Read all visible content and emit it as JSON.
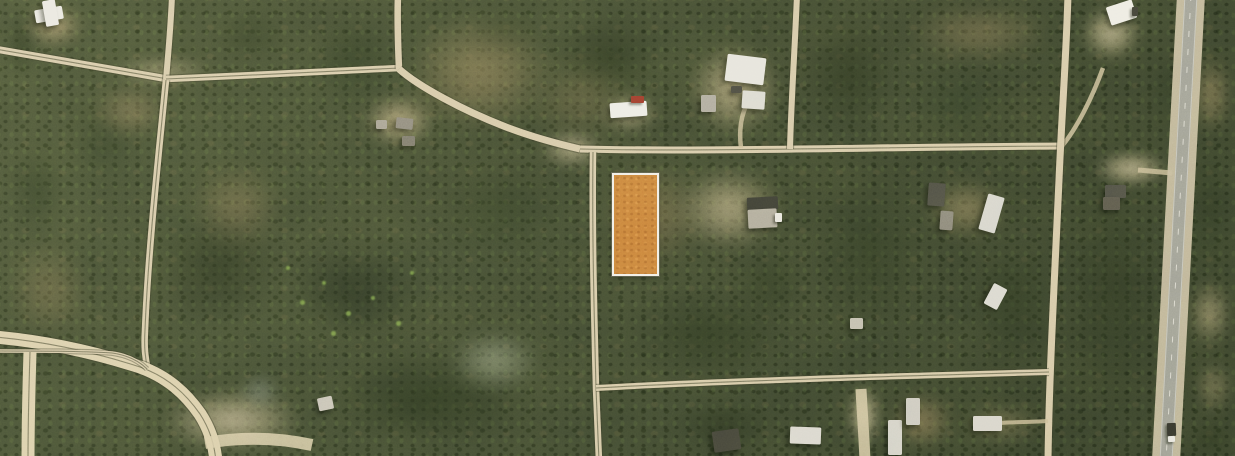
{
  "app": {
    "view_type": "aerial-satellite-parcel-view",
    "visible_text": "none"
  },
  "palette": {
    "forest_base": "#47503a",
    "dirt_road": "#d6c9ab",
    "bright_sand": "#dbcfae",
    "driveway": "#cdbf9d",
    "road_edge": "rgba(58,60,42,0.42)",
    "asphalt": "#a1a199",
    "shoulder": "#c7bda2",
    "parcel_fill": "#c9823e",
    "parcel_border": "#f1eee6"
  },
  "parcel": {
    "x": 612,
    "y": 173,
    "w": 43,
    "h": 99,
    "fill": "#c9823e",
    "border": "#f1eee6",
    "border_w": 2
  },
  "scene": {
    "clearings": [
      {
        "x": 18,
        "y": 0,
        "w": 72,
        "h": 52,
        "color": "#b9a57f",
        "opacity": 0.75,
        "blur": 6
      },
      {
        "x": 85,
        "y": 80,
        "w": 92,
        "h": 62,
        "color": "#9c8a66",
        "opacity": 0.6,
        "blur": 8
      },
      {
        "x": 100,
        "y": 52,
        "w": 125,
        "h": 38,
        "color": "#c6b894",
        "opacity": 0.55,
        "blur": 6
      },
      {
        "x": 355,
        "y": 88,
        "w": 88,
        "h": 66,
        "color": "#c3b28c",
        "opacity": 0.8,
        "blur": 6
      },
      {
        "x": 593,
        "y": 90,
        "w": 72,
        "h": 46,
        "color": "#c9bb96",
        "opacity": 0.7,
        "blur": 6
      },
      {
        "x": 678,
        "y": 33,
        "w": 112,
        "h": 112,
        "color": "#c5b690",
        "opacity": 0.75,
        "blur": 7
      },
      {
        "x": 533,
        "y": 126,
        "w": 78,
        "h": 46,
        "color": "#cec1a0",
        "opacity": 0.7,
        "blur": 6
      },
      {
        "x": 593,
        "y": 150,
        "w": 122,
        "h": 130,
        "color": "#a78f68",
        "opacity": 0.45,
        "blur": 9
      },
      {
        "x": 663,
        "y": 158,
        "w": 132,
        "h": 102,
        "color": "#c8b994",
        "opacity": 0.72,
        "blur": 8
      },
      {
        "x": 918,
        "y": 173,
        "w": 97,
        "h": 72,
        "color": "#a8956e",
        "opacity": 0.6,
        "blur": 8
      },
      {
        "x": 1075,
        "y": 0,
        "w": 72,
        "h": 66,
        "color": "#cdc09c",
        "opacity": 0.8,
        "blur": 6
      },
      {
        "x": 1085,
        "y": 147,
        "w": 92,
        "h": 43,
        "color": "#cfc2a0",
        "opacity": 0.82,
        "blur": 5
      },
      {
        "x": 1188,
        "y": 46,
        "w": 47,
        "h": 96,
        "color": "#a5916a",
        "opacity": 0.6,
        "blur": 7
      },
      {
        "x": 1185,
        "y": 273,
        "w": 50,
        "h": 82,
        "color": "#c2b28c",
        "opacity": 0.65,
        "blur": 7
      },
      {
        "x": 843,
        "y": 376,
        "w": 42,
        "h": 80,
        "color": "#cfc2a2",
        "opacity": 0.8,
        "blur": 5
      },
      {
        "x": 883,
        "y": 386,
        "w": 78,
        "h": 70,
        "color": "#a78f68",
        "opacity": 0.6,
        "blur": 7
      },
      {
        "x": 148,
        "y": 383,
        "w": 168,
        "h": 75,
        "color": "#cdbf9e",
        "opacity": 0.8,
        "blur": 7
      },
      {
        "x": 235,
        "y": 370,
        "w": 50,
        "h": 42,
        "color": "#8e9894",
        "opacity": 0.5,
        "blur": 6
      },
      {
        "x": 438,
        "y": 323,
        "w": 112,
        "h": 76,
        "color": "#b9c0a8",
        "opacity": 0.5,
        "blur": 8
      },
      {
        "x": 893,
        "y": 0,
        "w": 172,
        "h": 66,
        "color": "#9a8762",
        "opacity": 0.5,
        "blur": 9
      },
      {
        "x": 388,
        "y": 0,
        "w": 182,
        "h": 146,
        "color": "#9d8a64",
        "opacity": 0.6,
        "blur": 10
      },
      {
        "x": 518,
        "y": 53,
        "w": 122,
        "h": 92,
        "color": "#8a7a58",
        "opacity": 0.4,
        "blur": 10
      },
      {
        "x": 0,
        "y": 233,
        "w": 96,
        "h": 112,
        "color": "#96845f",
        "opacity": 0.45,
        "blur": 10
      },
      {
        "x": 183,
        "y": 158,
        "w": 107,
        "h": 97,
        "color": "#9a8762",
        "opacity": 0.5,
        "blur": 10
      },
      {
        "x": 953,
        "y": 403,
        "w": 97,
        "h": 42,
        "color": "#ab9870",
        "opacity": 0.5,
        "blur": 8
      },
      {
        "x": 1192,
        "y": 356,
        "w": 43,
        "h": 62,
        "color": "#b5a47e",
        "opacity": 0.5,
        "blur": 7
      }
    ],
    "wetland": {
      "x": 272,
      "y": 233,
      "w": 162,
      "h": 117,
      "color": "#232c1e",
      "opacity": 0.6,
      "blur": 10
    },
    "wetland_specks": [
      {
        "x": 300,
        "y": 300,
        "s": 5
      },
      {
        "x": 322,
        "y": 281,
        "s": 4
      },
      {
        "x": 346,
        "y": 311,
        "s": 5
      },
      {
        "x": 371,
        "y": 296,
        "s": 4
      },
      {
        "x": 396,
        "y": 321,
        "s": 5
      },
      {
        "x": 410,
        "y": 271,
        "s": 4
      },
      {
        "x": 331,
        "y": 331,
        "s": 5
      },
      {
        "x": 286,
        "y": 266,
        "s": 4
      }
    ],
    "speck_color": "#86a952",
    "forest_blobs": [
      {
        "x": 545,
        "y": 0,
        "w": 126,
        "h": 112,
        "color": "#2e3823",
        "opacity": 0.7
      },
      {
        "x": 788,
        "y": 0,
        "w": 122,
        "h": 150,
        "color": "#2c3622",
        "opacity": 0.65
      },
      {
        "x": 798,
        "y": 150,
        "w": 142,
        "h": 200,
        "color": "#313c26",
        "opacity": 0.6
      },
      {
        "x": 1053,
        "y": 150,
        "w": 122,
        "h": 290,
        "color": "#2e3823",
        "opacity": 0.6
      },
      {
        "x": 298,
        "y": 0,
        "w": 112,
        "h": 122,
        "color": "#2e3a25",
        "opacity": 0.6
      },
      {
        "x": 0,
        "y": 0,
        "w": 42,
        "h": 92,
        "color": "#2c3722",
        "opacity": 0.6
      },
      {
        "x": 138,
        "y": 198,
        "w": 162,
        "h": 142,
        "color": "#2a3421",
        "opacity": 0.55
      },
      {
        "x": 298,
        "y": 338,
        "w": 262,
        "h": 120,
        "color": "#28331f",
        "opacity": 0.7
      },
      {
        "x": 608,
        "y": 278,
        "w": 202,
        "h": 112,
        "color": "#2c3722",
        "opacity": 0.6
      },
      {
        "x": 958,
        "y": 228,
        "w": 112,
        "h": 152,
        "color": "#2d3823",
        "opacity": 0.6
      },
      {
        "x": 1178,
        "y": 128,
        "w": 60,
        "h": 162,
        "color": "#2f3a25",
        "opacity": 0.55
      },
      {
        "x": 1183,
        "y": 418,
        "w": 55,
        "h": 42,
        "color": "#2b3521",
        "opacity": 0.7
      },
      {
        "x": 898,
        "y": 58,
        "w": 122,
        "h": 92,
        "color": "#33402a",
        "opacity": 0.5
      },
      {
        "x": 418,
        "y": 148,
        "w": 162,
        "h": 122,
        "color": "#333f28",
        "opacity": 0.5
      },
      {
        "x": 58,
        "y": 88,
        "w": 92,
        "h": 112,
        "color": "#37432c",
        "opacity": 0.5
      },
      {
        "x": 658,
        "y": 388,
        "w": 132,
        "h": 72,
        "color": "#2b3521",
        "opacity": 0.6
      },
      {
        "x": 458,
        "y": 0,
        "w": 82,
        "h": 62,
        "color": "#36422a",
        "opacity": 0.45
      },
      {
        "x": 1138,
        "y": 38,
        "w": 62,
        "h": 112,
        "color": "#303b26",
        "opacity": 0.55
      },
      {
        "x": 0,
        "y": 128,
        "w": 72,
        "h": 122,
        "color": "#313d27",
        "opacity": 0.5
      },
      {
        "x": 723,
        "y": 238,
        "w": 92,
        "h": 92,
        "color": "#2f3a24",
        "opacity": 0.55
      },
      {
        "x": 203,
        "y": 0,
        "w": 92,
        "h": 72,
        "color": "#313d27",
        "opacity": 0.5
      }
    ],
    "roads": [
      {
        "name": "nw-road-west",
        "d": "M-5,49 C60,60 120,71 168,79",
        "w": 7,
        "color": "#d6c9ab",
        "edge": true,
        "line": true
      },
      {
        "name": "nw-road-north",
        "d": "M172,-5 C171,25 168,55 166,80",
        "w": 6,
        "color": "#d6c9ab",
        "edge": true
      },
      {
        "name": "west-mid-road",
        "d": "M166,79 C240,76 330,71 400,68",
        "w": 6.5,
        "color": "#d6c9ab",
        "edge": true,
        "line": true
      },
      {
        "name": "north-road-upper",
        "d": "M398,-5 C397,20 398,45 399,69",
        "w": 6.5,
        "color": "#d6c9ab",
        "edge": true
      },
      {
        "name": "junction-curve-se",
        "d": "M399,69 C418,86 462,110 506,127 C532,137 554,143 580,149",
        "w": 7,
        "color": "#d6c9ab",
        "edge": true
      },
      {
        "name": "main-east-road",
        "d": "M580,149 C700,152 880,147 1062,146",
        "w": 7,
        "color": "#d6c9ab",
        "edge": true,
        "line": true
      },
      {
        "name": "ne-driveway",
        "d": "M1062,146 C1077,128 1092,98 1103,68",
        "w": 4.5,
        "color": "#cdbf9d",
        "opacity": 0.85
      },
      {
        "name": "clearing-connector",
        "d": "M1138,170 C1150,171 1160,172 1172,173",
        "w": 5,
        "color": "#cdbf9d",
        "opacity": 0.8
      },
      {
        "name": "west-vertical-road",
        "d": "M166,80 C157,170 148,255 145,330 C144,347 145,358 148,370",
        "w": 6.5,
        "color": "#d6c9ab",
        "edge": true,
        "line": true
      },
      {
        "name": "mid-vertical-road",
        "d": "M593,152 C592,230 594,310 596,388 C597,410 598,435 599,461",
        "w": 6.5,
        "color": "#d6c9ab",
        "edge": true,
        "line": true
      },
      {
        "name": "north-vertical-road",
        "d": "M797,-5 C795,45 791,105 790,149",
        "w": 6,
        "color": "#d6c9ab",
        "edge": true
      },
      {
        "name": "east-vertical-road",
        "d": "M1068,-5 C1066,60 1062,110 1059,180 C1054,290 1049,380 1048,461",
        "w": 7,
        "color": "#d6c9ab",
        "edge": true
      },
      {
        "name": "south-east-road",
        "d": "M596,388 C720,381 900,376 1049,372",
        "w": 6,
        "color": "#d6c9ab",
        "edge": true,
        "line": true
      },
      {
        "name": "driveway-860",
        "d": "M861,389 C862,410 864,435 865,461",
        "w": 11,
        "color": "#d3c6a6",
        "opacity": 0.9
      },
      {
        "name": "driveway-1000",
        "d": "M1048,421 C1032,422 1015,422 1000,423",
        "w": 4,
        "color": "#cdbf9d",
        "opacity": 0.8
      },
      {
        "name": "cluster-driveway",
        "d": "M741,148 C739,132 741,117 746,106",
        "w": 4.5,
        "color": "#cdbf9d",
        "opacity": 0.8
      },
      {
        "name": "sw-road-upper",
        "d": "M-5,337 C50,342 100,354 140,367 C168,377 186,394 200,414 C209,428 214,442 216,461",
        "w": 13,
        "color": "#dbcfae",
        "edge": true,
        "line": true
      },
      {
        "name": "sw-road-thin",
        "d": "M-5,351 C40,351 80,351 112,353 C126,355 138,360 147,369",
        "w": 3.5,
        "color": "#d6c9ab",
        "edge": true,
        "line": true
      },
      {
        "name": "sw-vertical-road",
        "d": "M30,352 C29,385 28,420 28,461",
        "w": 13,
        "color": "#dbcfae",
        "edge": false,
        "line": true
      },
      {
        "name": "sw-sand-spur",
        "d": "M205,443 C245,436 280,438 312,445",
        "w": 12,
        "color": "#dbcfae",
        "opacity": 0.85
      },
      {
        "name": "highway-shoulder",
        "d": "M1191,-5 L1166,461",
        "w": 28,
        "color": "#c7bda2",
        "opacity": 0.95
      },
      {
        "name": "highway-asphalt",
        "d": "M1191,-5 L1166,461",
        "w": 13,
        "color": "#a1a199"
      },
      {
        "name": "highway-edge-left",
        "d": "M1185,-5 L1160,461",
        "w": 1,
        "color": "#dfded6",
        "opacity": 0.6
      },
      {
        "name": "highway-edge-right",
        "d": "M1197,-5 L1172,461",
        "w": 1,
        "color": "#dfded6",
        "opacity": 0.6
      },
      {
        "name": "highway-centerline",
        "d": "M1191,-5 L1166,461",
        "w": 1,
        "color": "#eceae0",
        "opacity": 0.75,
        "dash": "6 12"
      }
    ],
    "road_edge_color": "rgba(58,60,42,0.42)",
    "road_line_color": "rgba(55,58,42,0.55)",
    "structures": [
      {
        "name": "white-house-nw-wing",
        "x": 35,
        "y": 8,
        "w": 28,
        "h": 13,
        "rot": -10,
        "color": "#e9e7e0"
      },
      {
        "name": "white-house-nw-main",
        "x": 44,
        "y": 0,
        "w": 13,
        "h": 26,
        "rot": -10,
        "color": "#e9e7e0"
      },
      {
        "name": "farm-shed-1",
        "x": 376,
        "y": 120,
        "w": 11,
        "h": 9,
        "rot": 0,
        "color": "#a8a296"
      },
      {
        "name": "farm-shed-2",
        "x": 396,
        "y": 118,
        "w": 17,
        "h": 11,
        "rot": 6,
        "color": "#8f8a80"
      },
      {
        "name": "farm-shed-3",
        "x": 402,
        "y": 136,
        "w": 13,
        "h": 10,
        "rot": 0,
        "color": "#7e7a70"
      },
      {
        "name": "white-building-north",
        "x": 610,
        "y": 102,
        "w": 37,
        "h": 15,
        "rot": -4,
        "color": "#ecebe4"
      },
      {
        "name": "mobile-home-cluster-a",
        "x": 726,
        "y": 56,
        "w": 39,
        "h": 27,
        "rot": 7,
        "color": "#e6e4dc"
      },
      {
        "name": "mobile-home-cluster-b",
        "x": 742,
        "y": 91,
        "w": 23,
        "h": 18,
        "rot": 4,
        "color": "#dcdad2"
      },
      {
        "name": "mobile-home-cluster-c",
        "x": 701,
        "y": 95,
        "w": 15,
        "h": 17,
        "rot": 0,
        "color": "#aeaaa0"
      },
      {
        "name": "cluster-dark-shed",
        "x": 731,
        "y": 86,
        "w": 11,
        "h": 7,
        "rot": 0,
        "color": "#4c4c44"
      },
      {
        "name": "white-building-ne",
        "x": 1108,
        "y": 3,
        "w": 27,
        "h": 19,
        "rot": -18,
        "color": "#edebe3"
      },
      {
        "name": "dark-house-right-a",
        "x": 928,
        "y": 183,
        "w": 17,
        "h": 23,
        "rot": 4,
        "color": "#4f4f47"
      },
      {
        "name": "gray-house-right",
        "x": 940,
        "y": 211,
        "w": 13,
        "h": 19,
        "rot": 4,
        "color": "#8b877d"
      },
      {
        "name": "white-mobile-home-right",
        "x": 983,
        "y": 195,
        "w": 17,
        "h": 37,
        "rot": 16,
        "color": "#d7d5ce"
      },
      {
        "name": "white-shed-right",
        "x": 988,
        "y": 285,
        "w": 15,
        "h": 23,
        "rot": 28,
        "color": "#dbd9d1"
      },
      {
        "name": "dark-house-east-a",
        "x": 1105,
        "y": 185,
        "w": 21,
        "h": 13,
        "rot": 0,
        "color": "#505048"
      },
      {
        "name": "dark-house-east-b",
        "x": 1103,
        "y": 197,
        "w": 17,
        "h": 13,
        "rot": 0,
        "color": "#5c594f"
      },
      {
        "name": "center-mobile-home-roof",
        "x": 747,
        "y": 197,
        "w": 31,
        "h": 13,
        "rot": -3,
        "color": "#3e3f38"
      },
      {
        "name": "center-mobile-home-body",
        "x": 748,
        "y": 209,
        "w": 29,
        "h": 19,
        "rot": -3,
        "color": "#b1ac9f"
      },
      {
        "name": "dark-building-south",
        "x": 713,
        "y": 430,
        "w": 27,
        "h": 21,
        "rot": -8,
        "color": "#48483e"
      },
      {
        "name": "white-mobile-home-south",
        "x": 790,
        "y": 427,
        "w": 31,
        "h": 17,
        "rot": 2,
        "color": "#dbd8d0"
      },
      {
        "name": "white-shed-south",
        "x": 888,
        "y": 420,
        "w": 14,
        "h": 35,
        "rot": 0,
        "color": "#d5d2ca"
      },
      {
        "name": "white-trailers-south",
        "x": 906,
        "y": 398,
        "w": 14,
        "h": 27,
        "rot": 0,
        "color": "#cecbc3"
      },
      {
        "name": "white-mobile-home-south2",
        "x": 973,
        "y": 416,
        "w": 29,
        "h": 15,
        "rot": 0,
        "color": "#d8d5cd"
      },
      {
        "name": "small-shed-sw",
        "x": 318,
        "y": 397,
        "w": 15,
        "h": 13,
        "rot": -12,
        "color": "#c8c4b9"
      },
      {
        "name": "small-shed-mid",
        "x": 850,
        "y": 318,
        "w": 13,
        "h": 11,
        "rot": 0,
        "color": "#c2beb2"
      }
    ],
    "vehicles": [
      {
        "name": "red-truck",
        "x": 631,
        "y": 96,
        "w": 13,
        "h": 7,
        "rot": 0,
        "color": "#9c3a2e"
      },
      {
        "name": "white-car-center",
        "x": 775,
        "y": 213,
        "w": 7,
        "h": 9,
        "rot": 0,
        "color": "#e9e7e0"
      },
      {
        "name": "dark-car-ne",
        "x": 1132,
        "y": 7,
        "w": 6,
        "h": 9,
        "rot": 0,
        "color": "#3e3e38"
      },
      {
        "name": "highway-truck-trailer",
        "x": 1167,
        "y": 423,
        "w": 9,
        "h": 13,
        "rot": -2,
        "color": "#34342e"
      },
      {
        "name": "highway-truck-cab",
        "x": 1168,
        "y": 436,
        "w": 7,
        "h": 6,
        "rot": -2,
        "color": "#e9e7e0"
      }
    ]
  }
}
